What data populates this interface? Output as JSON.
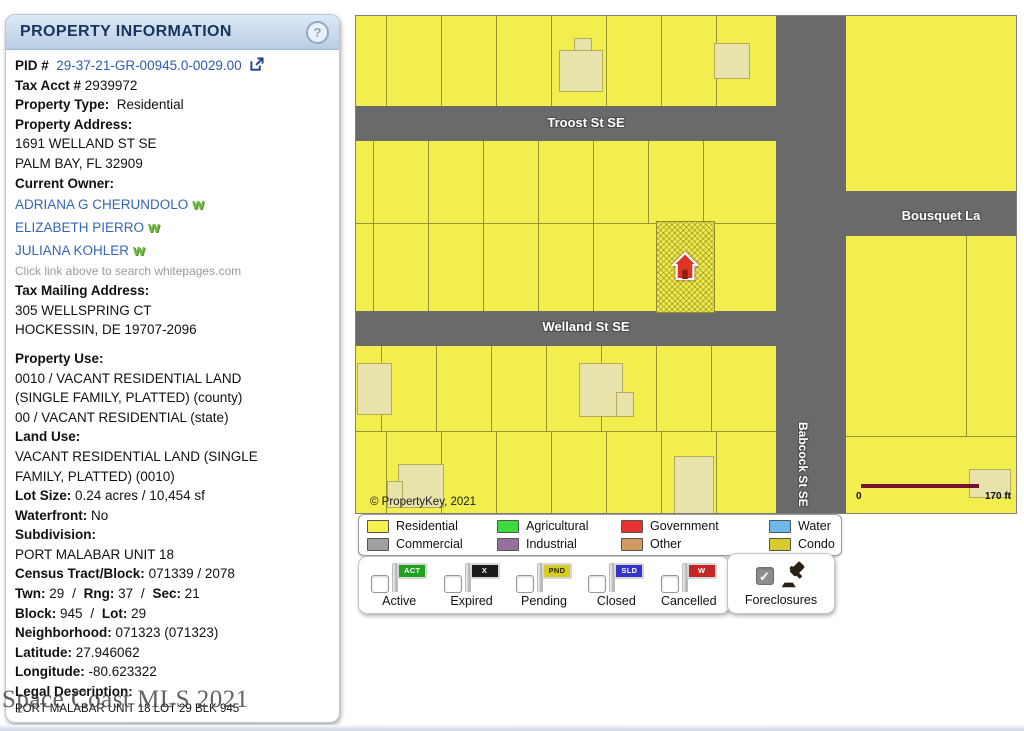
{
  "icons": {
    "help": "?",
    "check": "✓",
    "whitepages": "w"
  },
  "panel": {
    "title": "PROPERTY INFORMATION",
    "sep": "/",
    "pid": {
      "label": "PID #",
      "value": "29-37-21-GR-00945.0-0029.00"
    },
    "tax_acct": {
      "label": "Tax Acct #",
      "value": "2939972"
    },
    "property_type": {
      "label": "Property Type:",
      "value": "Residential"
    },
    "property_address": {
      "label": "Property Address:",
      "line1": "1691 WELLAND ST SE",
      "line2": "PALM BAY, FL 32909"
    },
    "current_owner": {
      "label": "Current Owner:",
      "owners": [
        "ADRIANA G CHERUNDOLO",
        "ELIZABETH PIERRO",
        "JULIANA KOHLER"
      ],
      "note": "Click link above to search whitepages.com"
    },
    "tax_mailing": {
      "label": "Tax Mailing Address:",
      "line1": "305 WELLSPRING CT",
      "line2": "HOCKESSIN, DE 19707-2096"
    },
    "property_use": {
      "label": "Property Use:",
      "line1": "0010 / VACANT RESIDENTIAL LAND",
      "line2": "(SINGLE FAMILY, PLATTED) (county)",
      "line3": "00 / VACANT RESIDENTIAL (state)"
    },
    "land_use": {
      "label": "Land Use:",
      "line1": "VACANT RESIDENTIAL LAND (SINGLE",
      "line2": "FAMILY, PLATTED) (0010)"
    },
    "lot_size": {
      "label": "Lot Size:",
      "value": "0.24 acres / 10,454 sf"
    },
    "waterfront": {
      "label": "Waterfront:",
      "value": "No"
    },
    "subdivision": {
      "label": "Subdivision:",
      "value": "PORT MALABAR UNIT 18"
    },
    "census": {
      "label": "Census Tract/Block:",
      "value": "071339 / 2078"
    },
    "twn": {
      "label": "Twn:",
      "value": "29"
    },
    "rng": {
      "label": "Rng:",
      "value": "37"
    },
    "sec": {
      "label": "Sec:",
      "value": "21"
    },
    "block": {
      "label": "Block:",
      "value": "945"
    },
    "lot": {
      "label": "Lot:",
      "value": "29"
    },
    "neighborhood": {
      "label": "Neighborhood:",
      "value": "071323 (071323)"
    },
    "latitude": {
      "label": "Latitude:",
      "value": "27.946062"
    },
    "longitude": {
      "label": "Longitude:",
      "value": "-80.623322"
    },
    "legal": {
      "label": "Legal Description:",
      "value": "PORT MALABAR UNIT 18 LOT 29 BLK 945"
    }
  },
  "watermark": "Space Coast MLS 2021",
  "map": {
    "streets": {
      "troost": "Troost St SE",
      "welland": "Welland St SE",
      "babcock": "Babcock St SE",
      "bousquet": "Bousquet La"
    },
    "copyright": "© PropertyKey, 2021",
    "scale": {
      "start": "0",
      "end": "170 ft"
    }
  },
  "legend": {
    "items": [
      {
        "label": "Residential",
        "color": "#f5f24e"
      },
      {
        "label": "Commercial",
        "color": "#a0a0a0"
      },
      {
        "label": "Agricultural",
        "color": "#3ddc3d"
      },
      {
        "label": "Industrial",
        "color": "#96719e"
      },
      {
        "label": "Government",
        "color": "#e83232"
      },
      {
        "label": "Other",
        "color": "#cf9a62"
      },
      {
        "label": "Water",
        "color": "#6cb9ea"
      },
      {
        "label": "Condo",
        "color": "#d5cb2a"
      }
    ]
  },
  "statuses": {
    "items": [
      {
        "label": "Active",
        "flag": "ACT",
        "flag_color": "#1ea21e",
        "flag_text_color": "#ffffff",
        "checked": false
      },
      {
        "label": "Expired",
        "flag": "X",
        "flag_color": "#1b1b1b",
        "flag_text_color": "#ffffff",
        "checked": false
      },
      {
        "label": "Pending",
        "flag": "PND",
        "flag_color": "#d9cb26",
        "flag_text_color": "#2a2a00",
        "checked": false
      },
      {
        "label": "Closed",
        "flag": "SLD",
        "flag_color": "#3434c8",
        "flag_text_color": "#ffffff",
        "checked": false
      },
      {
        "label": "Cancelled",
        "flag": "W",
        "flag_color": "#c52525",
        "flag_text_color": "#ffffff",
        "checked": false
      }
    ],
    "foreclosures": {
      "label": "Foreclosures",
      "checked": true
    }
  }
}
